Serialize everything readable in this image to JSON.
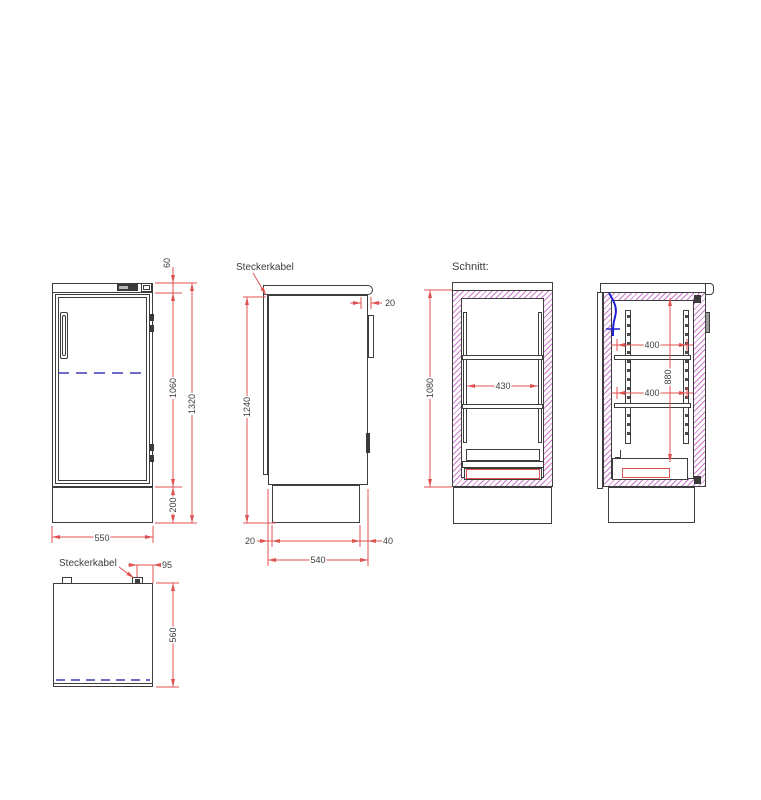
{
  "drawing": {
    "section_title": "Schnitt:",
    "labels": {
      "steckerkabel_side": "Steckerkabel",
      "steckerkabel_top": "Steckerkabel"
    },
    "views": {
      "front": {
        "dims": {
          "top_panel": "60",
          "door_height": "1060",
          "total_height": "1320",
          "base_height": "200",
          "width": "550"
        }
      },
      "side": {
        "dims": {
          "worktop_overhang": "20",
          "body_height": "1240",
          "back_inset": "20",
          "depth": "540",
          "front_inset": "40"
        }
      },
      "section_front": {
        "dims": {
          "inner_height": "1080",
          "inner_width": "430"
        }
      },
      "section_side": {
        "dims": {
          "upper_shelf_depth": "400",
          "lower_shelf_depth": "400",
          "rail_height": "880"
        }
      },
      "top": {
        "dims": {
          "cable_offset": "95",
          "depth": "560"
        }
      }
    },
    "colors": {
      "line": "#3d3d3d",
      "dimension": "#e05252",
      "hatch": "#cc7acc",
      "center_line": "#3b3bb4",
      "cable": "#1f1fd6"
    }
  }
}
